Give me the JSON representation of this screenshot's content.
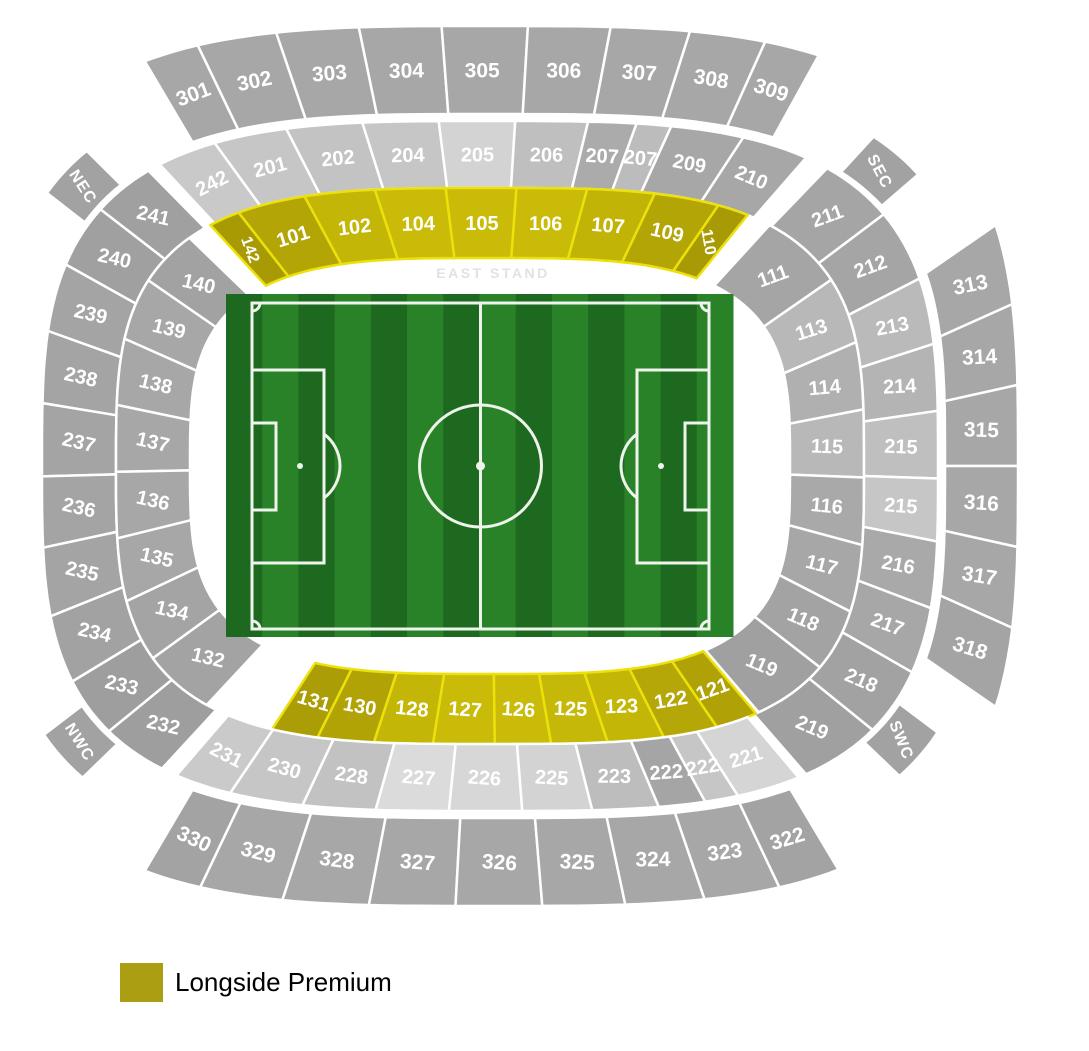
{
  "stage": {
    "width": 1089,
    "height": 1051,
    "background": "#ffffff"
  },
  "stand_label": "EAST STAND",
  "legend": {
    "items": [
      {
        "label": "Longside Premium",
        "color": "#ab9e13"
      }
    ]
  },
  "colors": {
    "section_border": "#ffffff",
    "premium_border": "#ece10b",
    "section_label": "#ffffff",
    "corner_fill": "#a2a2a2",
    "stand_text": "#e2e2e2"
  },
  "pitch": {
    "grass_light": "#2a8228",
    "grass_dark": "#1e6920",
    "line_color": "#eef3ec"
  },
  "corner_labels": [
    {
      "id": "nec",
      "label": "NEC"
    },
    {
      "id": "sec",
      "label": "SEC"
    },
    {
      "id": "nwc",
      "label": "NWC"
    },
    {
      "id": "swc",
      "label": "SWC"
    }
  ],
  "rings": [
    {
      "id": "tier3-top",
      "premium": false,
      "sections": [
        {
          "label": "301",
          "fill": "#a7a7a7",
          "w": 0.8
        },
        {
          "label": "302",
          "fill": "#a7a7a7",
          "w": 1.15
        },
        {
          "label": "303",
          "fill": "#a7a7a7",
          "w": 1.2
        },
        {
          "label": "304",
          "fill": "#a7a7a7",
          "w": 1.2
        },
        {
          "label": "305",
          "fill": "#a7a7a7",
          "w": 1.25
        },
        {
          "label": "306",
          "fill": "#a7a7a7",
          "w": 1.2
        },
        {
          "label": "307",
          "fill": "#a7a7a7",
          "w": 1.15
        },
        {
          "label": "308",
          "fill": "#a7a7a7",
          "w": 1.1
        },
        {
          "label": "309",
          "fill": "#a7a7a7",
          "w": 0.8
        }
      ]
    },
    {
      "id": "tier2-top",
      "premium": false,
      "sections": [
        {
          "label": "242",
          "fill": "#c9c9c9",
          "w": 0.85
        },
        {
          "label": "201",
          "fill": "#c6c6c6",
          "w": 1.05
        },
        {
          "label": "202",
          "fill": "#c3c3c3",
          "w": 1.1
        },
        {
          "label": "204",
          "fill": "#c6c6c6",
          "w": 1.1
        },
        {
          "label": "205",
          "fill": "#d3d3d3",
          "w": 1.1
        },
        {
          "label": "206",
          "fill": "#bfbfbf",
          "w": 1.05
        },
        {
          "label": "207",
          "fill": "#ababab",
          "w": 0.7
        },
        {
          "label": "207",
          "fill": "#bcbcbc",
          "w": 0.5
        },
        {
          "label": "209",
          "fill": "#a7a7a7",
          "w": 1.05
        },
        {
          "label": "210",
          "fill": "#a7a7a7",
          "w": 0.95
        }
      ]
    },
    {
      "id": "tier1-top",
      "premium": true,
      "sections": [
        {
          "label": "142",
          "fill": "#a89a05",
          "w": 0.5
        },
        {
          "label": "101",
          "fill": "#b3a506",
          "w": 1.1
        },
        {
          "label": "102",
          "fill": "#c4b607",
          "w": 1.15
        },
        {
          "label": "104",
          "fill": "#c9bb08",
          "w": 1.15
        },
        {
          "label": "105",
          "fill": "#c9bb08",
          "w": 1.15
        },
        {
          "label": "106",
          "fill": "#c9bb08",
          "w": 1.15
        },
        {
          "label": "107",
          "fill": "#c2b407",
          "w": 1.1
        },
        {
          "label": "109",
          "fill": "#b3a506",
          "w": 1.05
        },
        {
          "label": "110",
          "fill": "#a89a05",
          "w": 0.5
        }
      ]
    },
    {
      "id": "tier2-left",
      "premium": false,
      "sections": [
        {
          "label": "241",
          "fill": "#a0a0a0",
          "w": 0.95
        },
        {
          "label": "240",
          "fill": "#a0a0a0",
          "w": 1.0
        },
        {
          "label": "239",
          "fill": "#a4a4a4",
          "w": 1.05
        },
        {
          "label": "238",
          "fill": "#a4a4a4",
          "w": 1.1
        },
        {
          "label": "237",
          "fill": "#a4a4a4",
          "w": 1.1
        },
        {
          "label": "236",
          "fill": "#a4a4a4",
          "w": 1.1
        },
        {
          "label": "235",
          "fill": "#a4a4a4",
          "w": 1.05
        },
        {
          "label": "234",
          "fill": "#a2a2a2",
          "w": 1.05
        },
        {
          "label": "233",
          "fill": "#9e9e9e",
          "w": 0.95
        },
        {
          "label": "232",
          "fill": "#9e9e9e",
          "w": 1.0
        }
      ]
    },
    {
      "id": "tier1-left",
      "premium": false,
      "sections": [
        {
          "label": "140",
          "fill": "#a2a2a2",
          "w": 0.95
        },
        {
          "label": "139",
          "fill": "#a7a7a7",
          "w": 1.0
        },
        {
          "label": "138",
          "fill": "#a7a7a7",
          "w": 1.05
        },
        {
          "label": "137",
          "fill": "#a7a7a7",
          "w": 1.05
        },
        {
          "label": "136",
          "fill": "#a7a7a7",
          "w": 1.05
        },
        {
          "label": "135",
          "fill": "#a7a7a7",
          "w": 1.0
        },
        {
          "label": "134",
          "fill": "#a4a4a4",
          "w": 1.0
        },
        {
          "label": "132",
          "fill": "#a3a3a3",
          "w": 1.15
        }
      ]
    },
    {
      "id": "tier1-right",
      "premium": false,
      "sections": [
        {
          "label": "111",
          "fill": "#a5a5a5",
          "w": 1.25
        },
        {
          "label": "113",
          "fill": "#b8b8b8",
          "w": 1.0
        },
        {
          "label": "114",
          "fill": "#b0b0b0",
          "w": 1.0
        },
        {
          "label": "115",
          "fill": "#b8b8b8",
          "w": 1.0
        },
        {
          "label": "116",
          "fill": "#a9a9a9",
          "w": 1.0
        },
        {
          "label": "117",
          "fill": "#a7a7a7",
          "w": 1.0
        },
        {
          "label": "118",
          "fill": "#a3a3a3",
          "w": 0.95
        },
        {
          "label": "119",
          "fill": "#a0a0a0",
          "w": 1.15
        }
      ]
    },
    {
      "id": "tier2-right",
      "premium": false,
      "sections": [
        {
          "label": "211",
          "fill": "#a5a5a5",
          "w": 1.05
        },
        {
          "label": "212",
          "fill": "#a5a5a5",
          "w": 1.05
        },
        {
          "label": "213",
          "fill": "#bababa",
          "w": 0.95
        },
        {
          "label": "214",
          "fill": "#b4b4b4",
          "w": 0.95
        },
        {
          "label": "215",
          "fill": "#bfbfbf",
          "w": 0.95
        },
        {
          "label": "215",
          "fill": "#c6c6c6",
          "w": 0.9
        },
        {
          "label": "216",
          "fill": "#a9a9a9",
          "w": 0.95
        },
        {
          "label": "217",
          "fill": "#a7a7a7",
          "w": 0.95
        },
        {
          "label": "218",
          "fill": "#a2a2a2",
          "w": 1.0
        },
        {
          "label": "219",
          "fill": "#a0a0a0",
          "w": 1.15
        }
      ]
    },
    {
      "id": "tier3-right",
      "premium": false,
      "sections": [
        {
          "label": "313",
          "fill": "#a7a7a7",
          "w": 1.0
        },
        {
          "label": "314",
          "fill": "#a7a7a7",
          "w": 1.0
        },
        {
          "label": "315",
          "fill": "#a7a7a7",
          "w": 1.0
        },
        {
          "label": "316",
          "fill": "#a7a7a7",
          "w": 1.0
        },
        {
          "label": "317",
          "fill": "#a7a7a7",
          "w": 1.0
        },
        {
          "label": "318",
          "fill": "#a4a4a4",
          "w": 1.0
        }
      ]
    },
    {
      "id": "tier1-bottom",
      "premium": true,
      "sections": [
        {
          "label": "131",
          "fill": "#ab9d05",
          "w": 0.9
        },
        {
          "label": "130",
          "fill": "#b1a306",
          "w": 1.1
        },
        {
          "label": "128",
          "fill": "#c4b607",
          "w": 1.15
        },
        {
          "label": "127",
          "fill": "#c9bb08",
          "w": 1.15
        },
        {
          "label": "126",
          "fill": "#c9bb08",
          "w": 1.15
        },
        {
          "label": "125",
          "fill": "#c6b808",
          "w": 1.1
        },
        {
          "label": "123",
          "fill": "#c4b607",
          "w": 1.1
        },
        {
          "label": "122",
          "fill": "#b5a707",
          "w": 1.05
        },
        {
          "label": "121",
          "fill": "#b0a206",
          "w": 0.8
        }
      ]
    },
    {
      "id": "tier2-bottom",
      "premium": false,
      "sections": [
        {
          "label": "231",
          "fill": "#cacaca",
          "w": 0.85
        },
        {
          "label": "230",
          "fill": "#c6c6c6",
          "w": 1.1
        },
        {
          "label": "228",
          "fill": "#c2c2c2",
          "w": 1.1
        },
        {
          "label": "227",
          "fill": "#dbdbdb",
          "w": 1.1
        },
        {
          "label": "226",
          "fill": "#d7d7d7",
          "w": 1.1
        },
        {
          "label": "225",
          "fill": "#d3d3d3",
          "w": 1.05
        },
        {
          "label": "223",
          "fill": "#bdbdbd",
          "w": 1.0
        },
        {
          "label": "222",
          "fill": "#a5a5a5",
          "w": 0.7
        },
        {
          "label": "222",
          "fill": "#c6c6c6",
          "w": 0.5
        },
        {
          "label": "221",
          "fill": "#d5d5d5",
          "w": 0.95
        }
      ]
    },
    {
      "id": "tier3-bottom",
      "premium": false,
      "sections": [
        {
          "label": "330",
          "fill": "#a3a3a3",
          "w": 0.8
        },
        {
          "label": "329",
          "fill": "#a7a7a7",
          "w": 1.15
        },
        {
          "label": "328",
          "fill": "#a7a7a7",
          "w": 1.2
        },
        {
          "label": "327",
          "fill": "#a7a7a7",
          "w": 1.2
        },
        {
          "label": "326",
          "fill": "#a7a7a7",
          "w": 1.2
        },
        {
          "label": "325",
          "fill": "#a7a7a7",
          "w": 1.15
        },
        {
          "label": "324",
          "fill": "#a7a7a7",
          "w": 1.1
        },
        {
          "label": "323",
          "fill": "#a7a7a7",
          "w": 1.05
        },
        {
          "label": "322",
          "fill": "#a3a3a3",
          "w": 0.85
        }
      ]
    }
  ]
}
